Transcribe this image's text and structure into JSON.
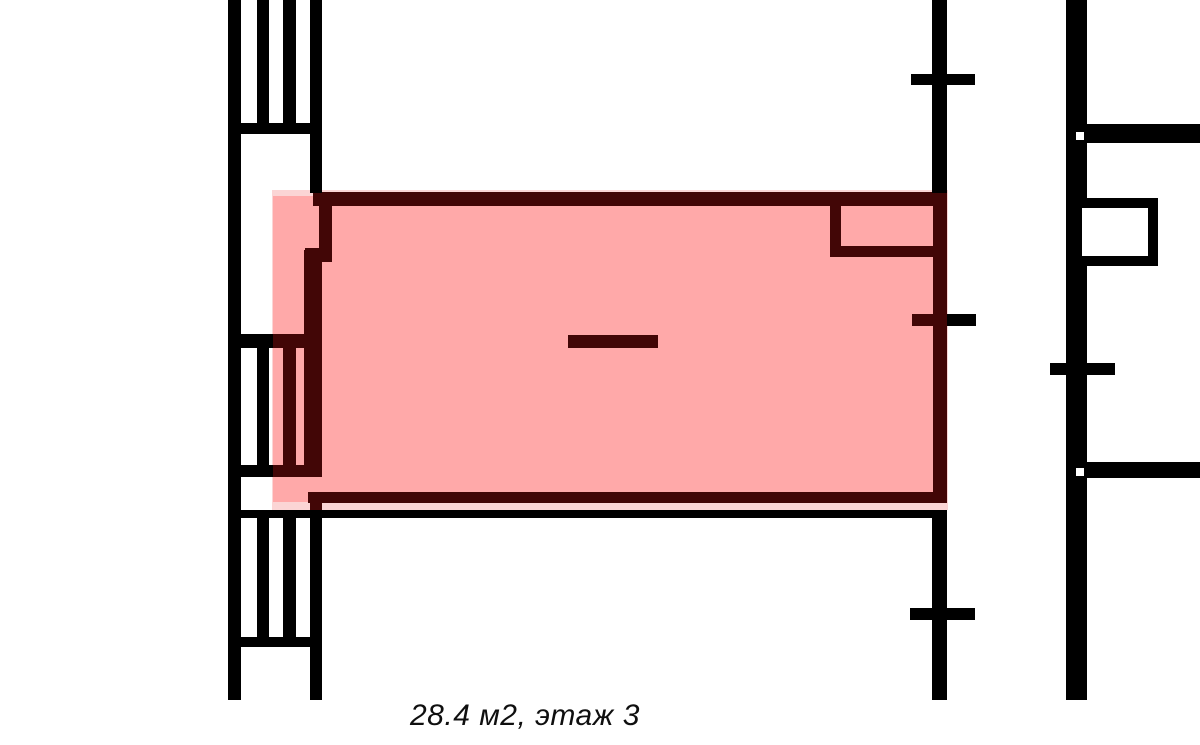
{
  "page": {
    "type": "apartment-floor-plan"
  },
  "caption": {
    "text": "28.4 м2, этаж 3",
    "area_m2": "28.4",
    "floor": "3"
  },
  "highlight": {
    "fill_color": "#FFA9A9",
    "halo_color": "#FBD5D5",
    "outline_color": "#420606",
    "status": "selected-unit"
  },
  "plan": {
    "wall_color": "#000000",
    "background_color": "#FFFFFF"
  }
}
